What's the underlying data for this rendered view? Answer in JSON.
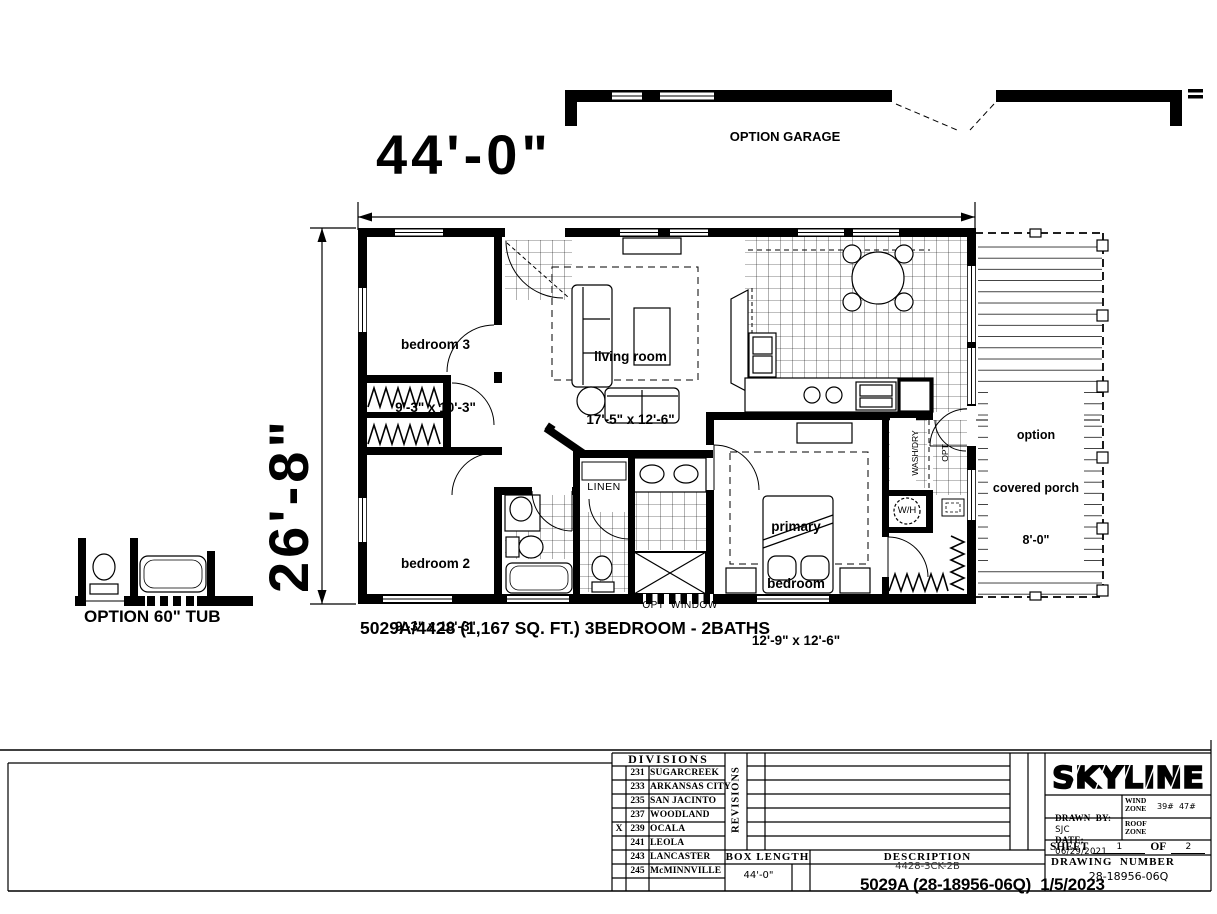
{
  "colors": {
    "ink": "#000000",
    "paper": "#ffffff"
  },
  "plan": {
    "garage_label": "OPTION GARAGE",
    "width_dim": "44'-0\"",
    "depth_dim": "26'-8\"",
    "rooms": {
      "bedroom3": {
        "name": "bedroom 3",
        "size": "9'-3\" x 10'-3\""
      },
      "living": {
        "name": "living room",
        "size": "17'-5\" x 12'-6\""
      },
      "bedroom2": {
        "name": "bedroom 2",
        "size": "9'-3\" x 10'-3\""
      },
      "primary": {
        "line1": "primary",
        "line2": "bedroom",
        "size": "12'-9\" x 12'-6\""
      },
      "porch": {
        "line1": "option",
        "line2": "covered porch",
        "line3": "8'-0\""
      }
    },
    "fixtures": {
      "linen": "LINEN",
      "washdry_line1": "WASH/DRY",
      "washdry_line2": "OPT",
      "water_heater": "W/H",
      "opt_window": "OPT  WINDOW",
      "option_tub": "OPTION 60\" TUB"
    },
    "caption": "5029A/4428 (1,167 SQ. FT.) 3BEDROOM - 2BATHS"
  },
  "titleblock": {
    "divisions_header": "DIVISIONS",
    "divisions": [
      {
        "check": "",
        "code": "231",
        "name": "SUGARCREEK"
      },
      {
        "check": "",
        "code": "233",
        "name": "ARKANSAS CITY"
      },
      {
        "check": "",
        "code": "235",
        "name": "SAN JACINTO"
      },
      {
        "check": "",
        "code": "237",
        "name": "WOODLAND"
      },
      {
        "check": "X",
        "code": "239",
        "name": "OCALA"
      },
      {
        "check": "",
        "code": "241",
        "name": "LEOLA"
      },
      {
        "check": "",
        "code": "243",
        "name": "LANCASTER"
      },
      {
        "check": "",
        "code": "245",
        "name": "McMINNVILLE"
      }
    ],
    "revisions_label": "REVISIONS",
    "box_length_label": "BOX LENGTH",
    "box_length_value": "44'-0\"",
    "description_label": "DESCRIPTION",
    "description_value": "4428-3CK-2B",
    "drawing_number_label": "DRAWING  NUMBER",
    "drawing_number_value": "28-18956-06Q",
    "brand": "SKYLINE",
    "drawn_by_label": "DRAWN  BY:",
    "drawn_by_value": "SJC",
    "wind_zone_line1": "WIND",
    "wind_zone_line2": "ZONE",
    "wind_zone_value": "39#  47#",
    "date_label": "DATE:",
    "date_value": "06/29/2021",
    "roof_zone_line1": "ROOF",
    "roof_zone_line2": "ZONE",
    "sheet_label": "SHEET",
    "sheet_value": "1",
    "sheet_of_label": "OF",
    "sheet_of_value": "2",
    "stamp": "5029A (28-18956-06Q)  1/5/2023"
  }
}
